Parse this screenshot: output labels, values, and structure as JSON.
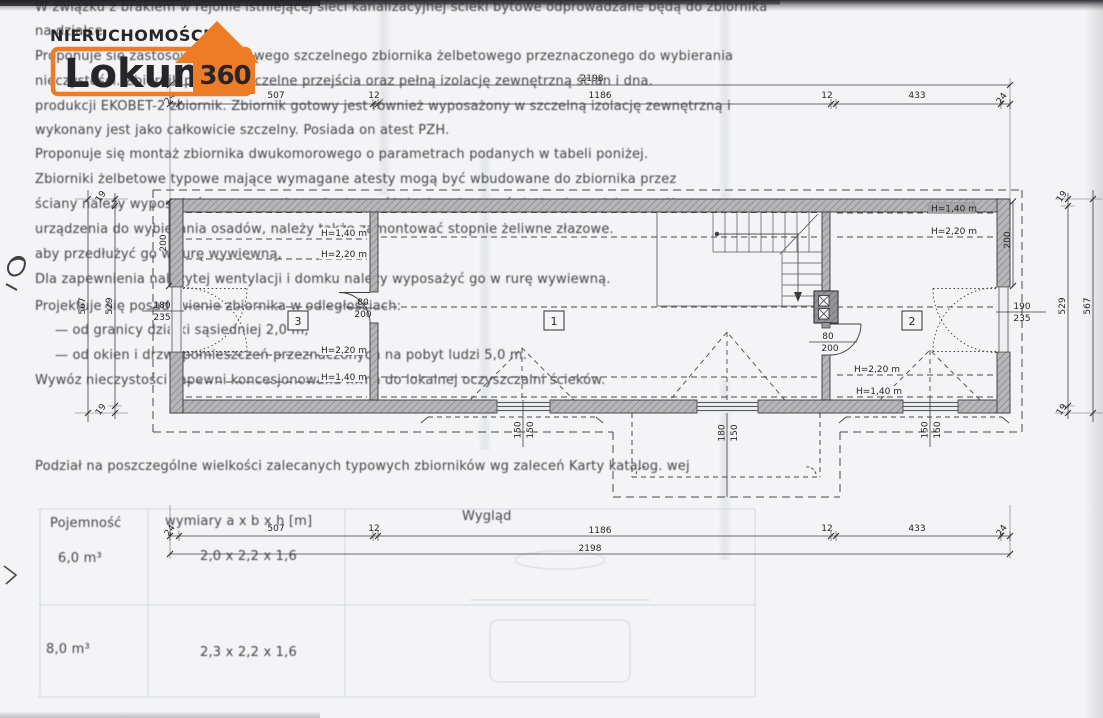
{
  "logo": {
    "top": "NIERUCHOMOŚCI",
    "main": "Lokum",
    "badge": "360",
    "orange": "#ee7c26"
  },
  "dims": {
    "total": "2198",
    "seg": [
      "24",
      "507",
      "12",
      "1186",
      "12",
      "433",
      "24"
    ],
    "side_total": "567",
    "side_seg": [
      "19",
      "529",
      "19"
    ],
    "pier": "200"
  },
  "rooms": {
    "r1": "1",
    "r2": "2",
    "r3": "3"
  },
  "heights": {
    "h140": "H=1,40 m",
    "h220": "H=2,20 m"
  },
  "openings": {
    "door_left": {
      "w": "180",
      "h": "235"
    },
    "door_right": {
      "w": "190",
      "h": "235"
    },
    "door_int": {
      "w": "80",
      "h": "200"
    },
    "win_std": {
      "w": "150",
      "h": "150"
    },
    "win_dormer": {
      "w": "180",
      "h": "150"
    }
  },
  "ghost": {
    "lines": [
      "W związku z brakiem w rejonie istniejącej sieci kanalizacyjnej ścieki bytowe odprowadzane będą do zbiornika",
      "na działce.",
      "Proponuje się zastosowanie gotowego szczelnego zbiornika żelbetowego przeznaczonego do wybierania",
      "nieczystości. Zbiornik posiada szczelne przejścia oraz pełną izolację zewnętrzną ścian i dna.",
      "produkcji EKOBET-2 zbiornik. Zbiornik gotowy jest również wyposażony w szczelną izolację zewnętrzną i",
      "wykonany jest jako całkowicie szczelny. Posiada on atest PZH.",
      "Proponuje się montaż zbiornika dwukomorowego o parametrach podanych w tabeli poniżej.",
      "Zbiorniki żelbetowe typowe mające wymagane atesty mogą być wbudowane do zbiornika przez",
      "ściany należy wyposażyć w oprzyrządowanie do opróżniania, włazy w świetle nie mniejszym niż",
      "urządzenia do wybierania osadów, należy także zamontować stopnie żeliwne złazowe.",
      "aby przedłużyć go w rurę wywiewną,",
      "Dla zapewnienia należytej wentylacji i domku należy wyposażyć go w rurę wywiewną.",
      "Projektuje się posadowienie zbiornika w odległościach:",
      "—   od granicy działki sąsiedniej 2,0 m,",
      "—   od okien i drzwi pomieszczeń przeznaczonych na pobyt ludzi 5,0 m.",
      "Wywóz nieczystości zapewni koncesjonowana firma do lokalnej oczyszczalni ścieków.",
      "Podział na poszczególne wielkości zalecanych typowych zbiorników wg zaleceń Karty katalog. wej"
    ],
    "table": {
      "c1": "Pojemność",
      "c2": "wymiary a x b x h [m]",
      "c3": "Wygląd",
      "r1a": "6,0 m³",
      "r1b": "2,0 x 2,2 x 1,6",
      "r2a": "8,0 m³",
      "r2b": "2,3 x 2,2 x 1,6"
    }
  }
}
